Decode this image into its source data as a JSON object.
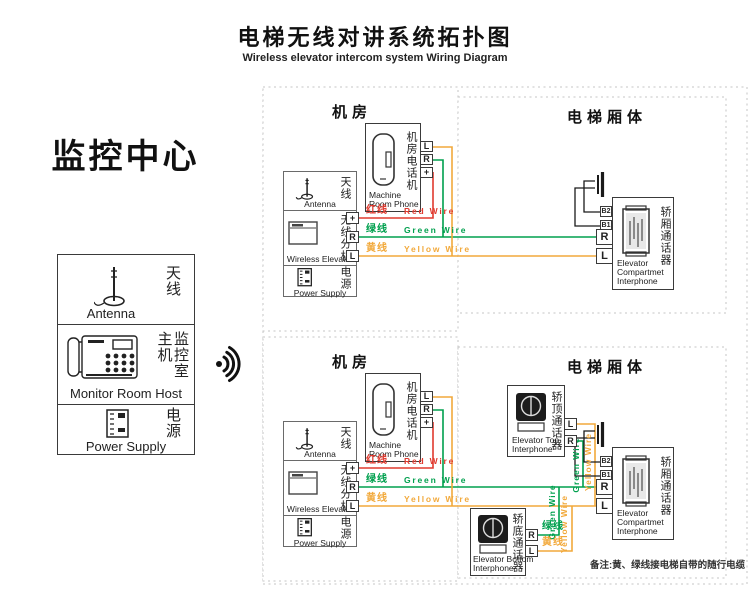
{
  "title": {
    "zh": "电梯无线对讲系统拓扑图",
    "en": "Wireless elevator intercom system Wiring Diagram"
  },
  "monitor_center": {
    "heading": "监控中心",
    "antenna": {
      "zh": "天线",
      "en": "Antenna"
    },
    "host": {
      "zh": "监控室主机",
      "en": "Monitor Room Host"
    },
    "power": {
      "zh": "电源",
      "en": "Power Supply"
    }
  },
  "machine_room": {
    "title": "机房",
    "phone": {
      "zh": "机房电话机",
      "en_line1": "Machine",
      "en_line2": "Room Phone",
      "t_l": "L",
      "t_r": "R",
      "t_plus": "+"
    },
    "antenna": {
      "zh": "天线",
      "en": "Antenna"
    },
    "wireless": {
      "zh": "无线分机",
      "en": "Wireless Elevator",
      "t_plus": "+",
      "t_r": "R",
      "t_l": "L"
    },
    "power": {
      "zh": "电源",
      "en": "Power Supply"
    }
  },
  "elevator_body": {
    "title": "电梯厢体",
    "call_button": {
      "zh": "呼叫按钮",
      "en": "Call Button"
    },
    "compartment": {
      "zh": "轿厢通话器",
      "en_line1": "Elevator",
      "en_line2": "Compartmet",
      "en_line3": "Interphone",
      "t_b2": "B2",
      "t_b1": "B1",
      "t_r": "R",
      "t_l": "L"
    },
    "top_interphone": {
      "zh": "轿顶通话器",
      "en_line1": "Elevator Top",
      "en_line2": "Interphone",
      "t_l": "L",
      "t_r": "R"
    },
    "bottom_interphone": {
      "zh": "轿底通话器",
      "en_line1": "Elevator Bottom",
      "en_line2": "Interphone",
      "t_r": "R",
      "t_l": "L"
    }
  },
  "wires": {
    "red": {
      "zh": "红线",
      "en": "Red Wire",
      "color": "#e03a2f"
    },
    "green": {
      "zh": "绿线",
      "en": "Green Wire",
      "color": "#00a04e"
    },
    "yellow": {
      "zh": "黄线",
      "en": "Yellow Wire",
      "color": "#f2a93b"
    }
  },
  "note": "备注:黄、绿线接电梯自带的随行电缆"
}
